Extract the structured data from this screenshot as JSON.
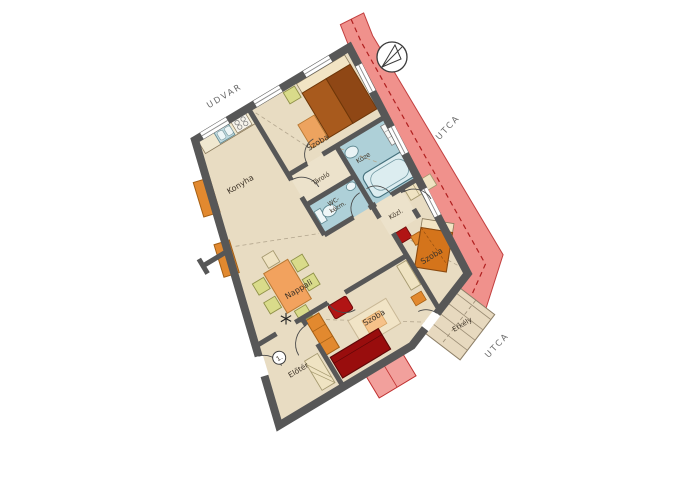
{
  "floor_plan": {
    "labels": {
      "udvar": "UDVAR",
      "utca_right": "UTCA",
      "utca_bottom": "UTCA",
      "konyha": "Konyha",
      "szoba_top": "Szoba",
      "szoba_middle": "Szoba",
      "szoba_bottom": "Szoba",
      "tarolo": "Tároló",
      "wc_line1": "WC-",
      "wc_line2": "kézm.",
      "kozl": "Közl.",
      "furdo": "Köze",
      "nappali": "Nappali",
      "eloter": "Előtér",
      "erkely": "Erkély",
      "entrance_number": "1."
    },
    "colors": {
      "wall": "#575757",
      "floor": "#e8dcc2",
      "wet_room": "#aed0d8",
      "street_band": "#f0918c",
      "street_border": "#c03030",
      "furniture_orange": "#e2892f",
      "furniture_red": "#b11414",
      "furniture_dark_red": "#990d0d",
      "bed_brown": "#a85a1d",
      "bed_brown_dark": "#8f4715",
      "cream": "#f2e4c4",
      "chair_green": "#d9db8a",
      "rug_orange": "#eda35f",
      "rug_peach": "#f6c289",
      "balcony": "#e7d9bf"
    }
  }
}
